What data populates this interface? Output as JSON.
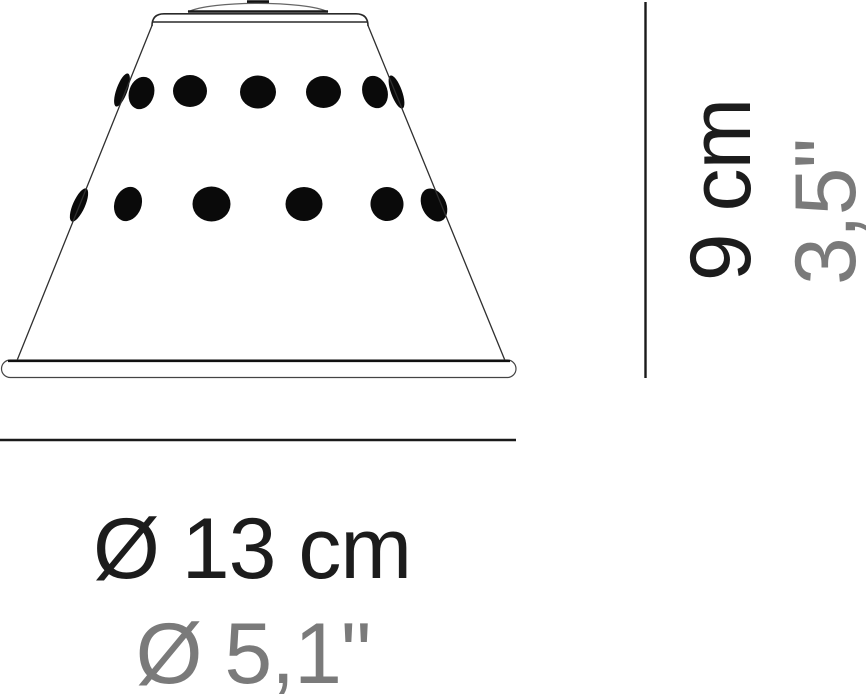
{
  "canvas": {
    "background": "#ffffff",
    "width": 867,
    "height": 695
  },
  "drawing": {
    "subject": "perforated-cone-lampshade",
    "outline_color": "#2a2a2a",
    "hole_color": "#0a0a0a",
    "visible_hole_count": 13
  },
  "dimensions": {
    "height": {
      "metric": "9 cm",
      "imperial": "3,5\""
    },
    "diameter": {
      "metric": "Ø 13 cm",
      "imperial": "Ø 5,1\""
    },
    "metric_text_color": "#1c1c1c",
    "imperial_text_color": "#7a7a7a",
    "line_color": "#1a1a1a"
  }
}
